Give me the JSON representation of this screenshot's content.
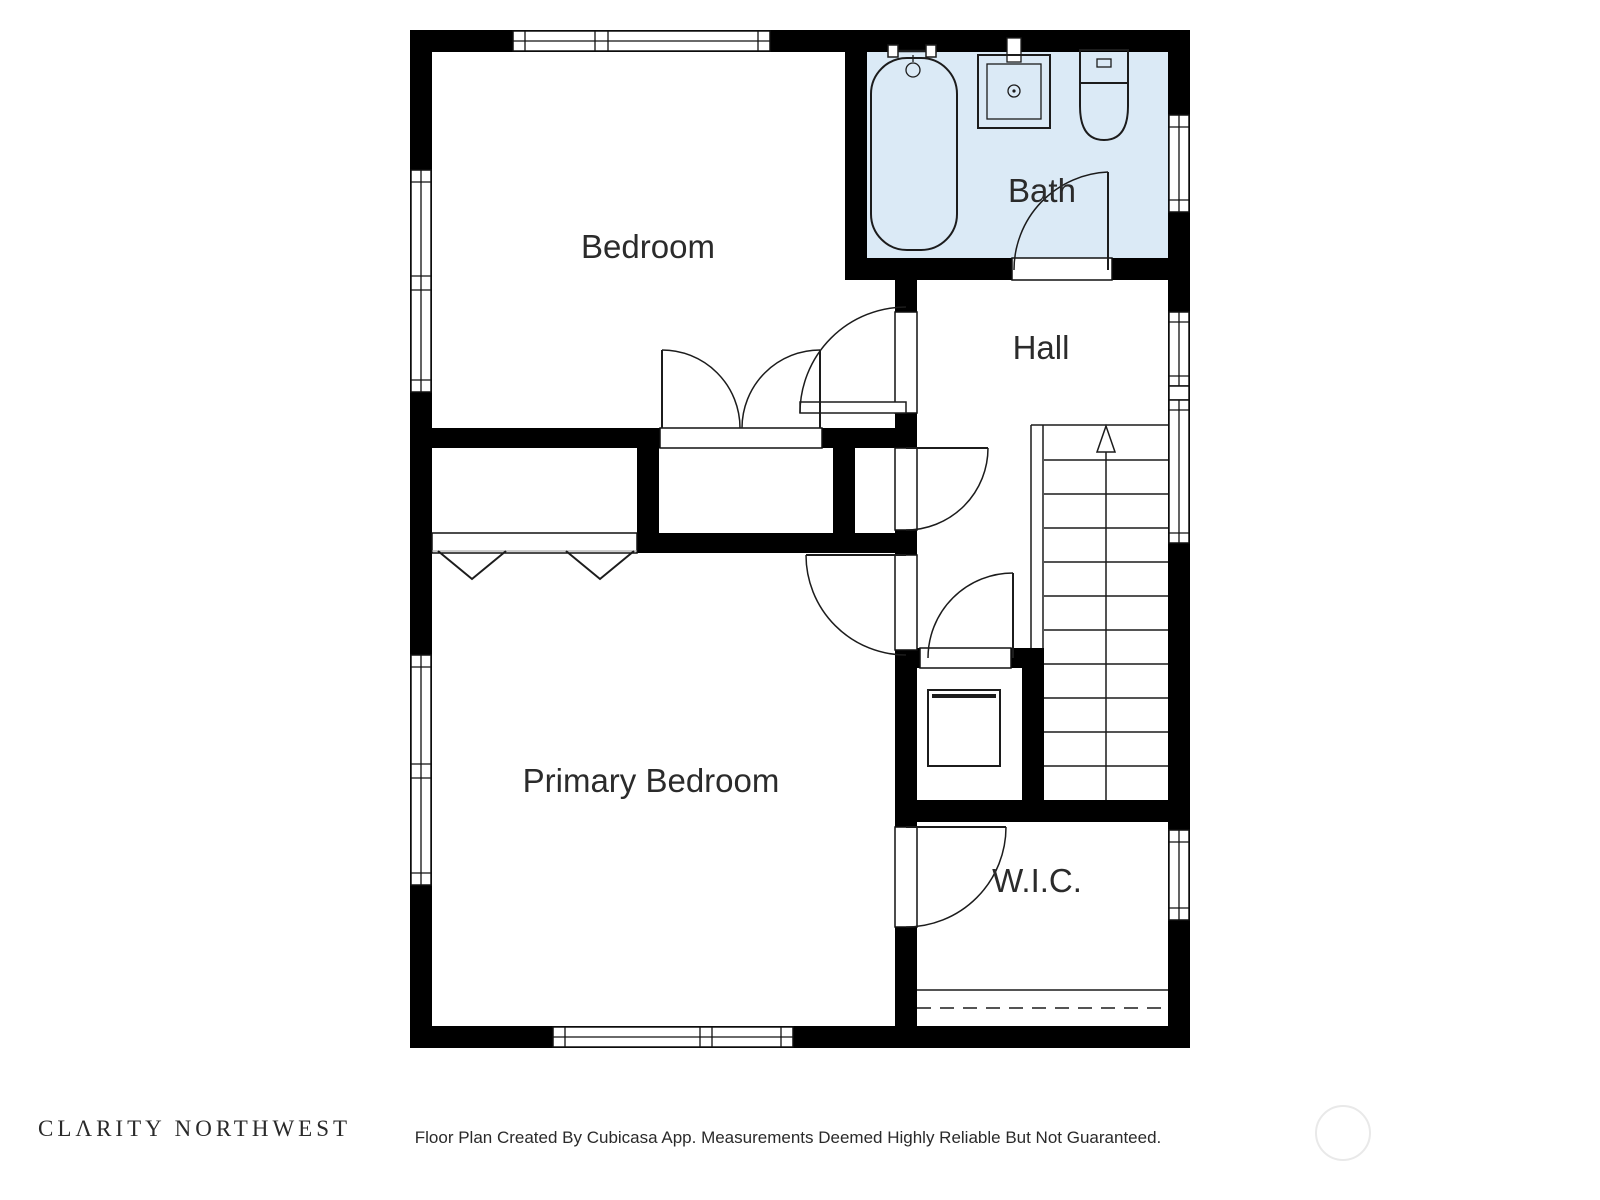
{
  "plan": {
    "rooms": [
      {
        "id": "bedroom",
        "label": "Bedroom"
      },
      {
        "id": "bath",
        "label": "Bath"
      },
      {
        "id": "hall",
        "label": "Hall"
      },
      {
        "id": "primary_bedroom",
        "label": "Primary Bedroom"
      },
      {
        "id": "wic",
        "label": "W.I.C."
      }
    ],
    "colors": {
      "wall": "#000000",
      "bath_floor": "#dbeaf6",
      "line": "#1c1c1c",
      "label_text": "#2b2b2b",
      "watermark_circle": "#e9e9e9"
    },
    "fixtures": [
      {
        "icon": "bathtub-icon",
        "room": "Bath"
      },
      {
        "icon": "sink-icon",
        "room": "Bath"
      },
      {
        "icon": "toilet-icon",
        "room": "Bath"
      },
      {
        "icon": "water-heater-icon",
        "room": "Hall"
      },
      {
        "icon": "stairs-up-icon",
        "room": "Hall"
      }
    ],
    "stairs": {
      "direction": "up",
      "tread_count": 11
    }
  },
  "footer": {
    "brand": "CLΛRITY NORTHWEST",
    "disclaimer": "Floor Plan Created By Cubicasa App. Measurements Deemed Highly Reliable But Not Guaranteed."
  }
}
